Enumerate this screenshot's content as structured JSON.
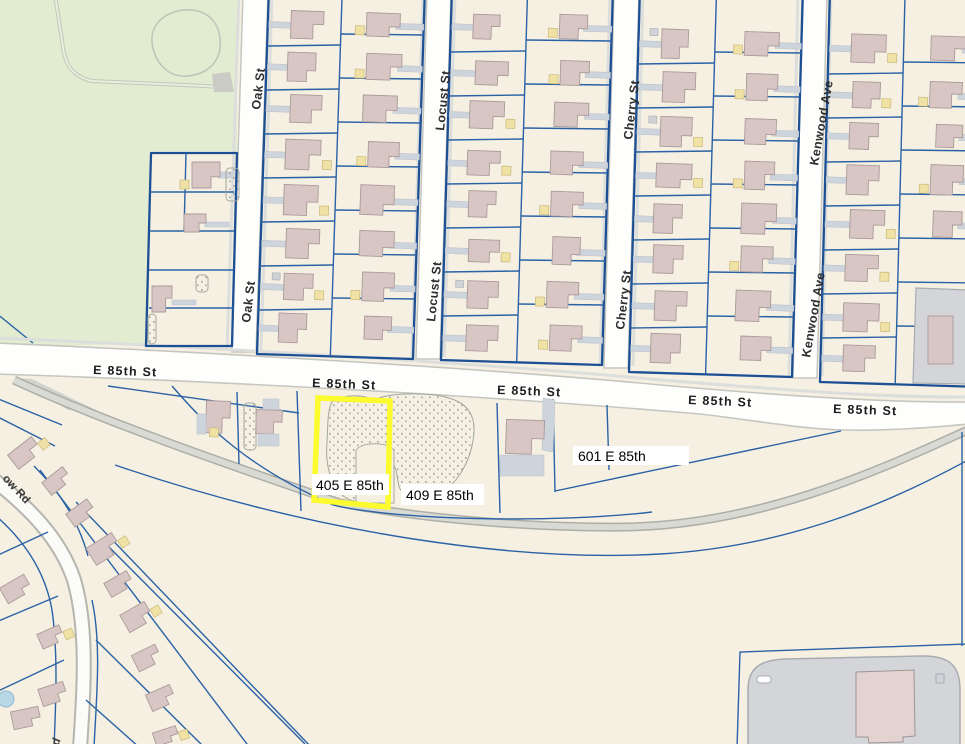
{
  "map": {
    "type": "parcel-map",
    "highlighted_parcel": "405 E 85th"
  },
  "labels": {
    "e85th": "E 85th St",
    "oak": "Oak St",
    "locust": "Locust St",
    "cherry": "Cherry St",
    "kenwood": "Kenwood Ave",
    "addr405": "405 E 85th",
    "addr409": "409 E 85th",
    "addr601": "601 E 85th",
    "road_partial": "ow Rd",
    "road_partial_bottom": "Rd"
  },
  "colors": {
    "bg": "#f5f0e2",
    "park": "#e2ecd0",
    "parkLine": "#c2c7ba",
    "blue": "#2a62a5",
    "blueDark": "#1d4f94",
    "street": "#fefefd",
    "casing": "#c6c6c0",
    "sidewalk": "#dcdedc",
    "bld": "#d8c6c5",
    "bldStroke": "#ab9a99",
    "drv": "#ced4dc",
    "gar": "#f0e2a5",
    "stipDot": "#8d939b",
    "rail": "#dadad5",
    "railEdge": "#aeaea8",
    "highlight": "#fbfb2d",
    "lot": "#d3d5d9",
    "lotLine": "#a8acb2",
    "pool": "#b8d8e8"
  }
}
